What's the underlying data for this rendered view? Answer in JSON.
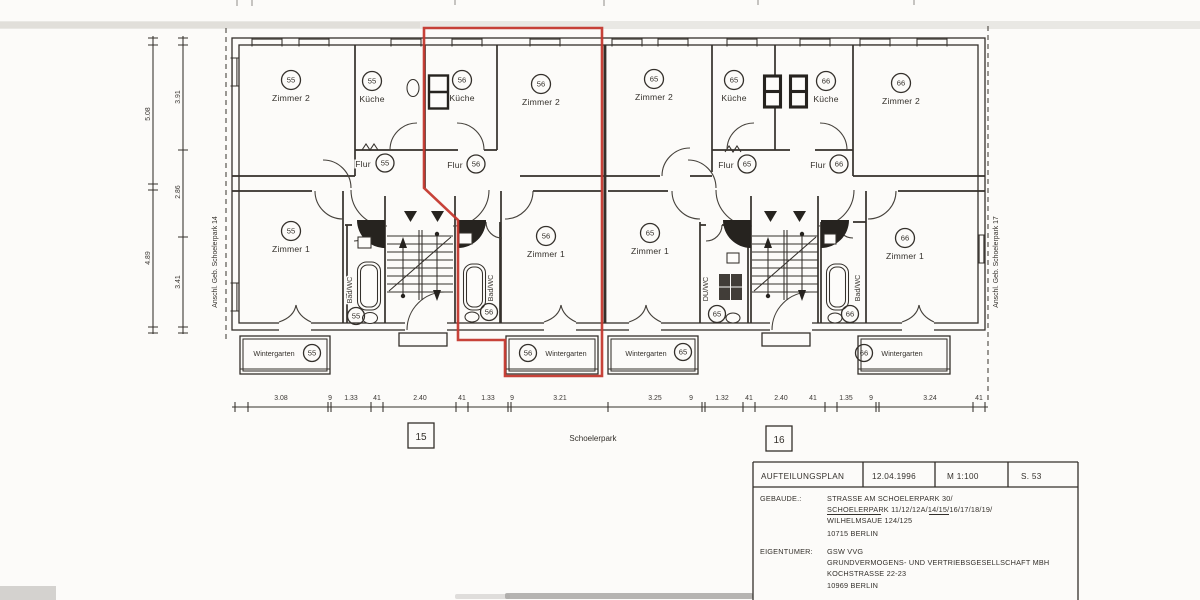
{
  "colors": {
    "paper": "#fcfbf9",
    "ink": "#34302b",
    "red_outline": "#c4382e"
  },
  "labels": {
    "zimmer1": "Zimmer 1",
    "zimmer2": "Zimmer 2",
    "kueche": "Küche",
    "flur": "Flur",
    "badwc": "Bad/WC",
    "duwc": "DU/WC",
    "wintergarten": "Wintergarten"
  },
  "units": {
    "u55": "55",
    "u56": "56",
    "u65": "65",
    "u66": "66"
  },
  "site": {
    "anschluss_left": "Anschl. Geb. Schoelerpark 14",
    "anschluss_right": "Anschl. Geb. Schoelerpark 17",
    "street": "Schoelerpark",
    "entrance_left": "15",
    "entrance_right": "16"
  },
  "dims": {
    "bottom_left": [
      "3.08",
      "9",
      "1.33",
      "41",
      "2.40",
      "41",
      "1.33",
      "9",
      "3.21"
    ],
    "bottom_right": [
      "3.25",
      "9",
      "1.32",
      "41",
      "2.40",
      "41",
      "1.35",
      "9",
      "3.24",
      "41"
    ],
    "left_outer": [
      "5.08",
      "4.89"
    ],
    "left_inner": [
      "3.91",
      "2.86",
      "3.41"
    ]
  },
  "title_block": {
    "row": {
      "title": "AUFTEILUNGSPLAN",
      "date": "12.04.1996",
      "scale": "M 1:100",
      "sheet": "S. 53"
    },
    "building_label": "GEBAUDE.:",
    "building": {
      "line1": "STRASSE AM SCHOELERPARK 30/",
      "line2_u1": "SCHOELERPARK",
      "line2_m": " 11/12/12A/14/",
      "line2_u2": "15/16",
      "line2_e": "/17/18/19/",
      "line3": "WILHELMSAUE 124/125",
      "line4": "10715 BERLIN"
    },
    "owner_label": "EIGENTUMER:",
    "owner": {
      "line1": "GSW VVG",
      "line2": "GRUNDVERMOGENS- UND VERTRIEBSGESELLSCHAFT MBH",
      "line3": "KOCHSTRASSE 22-23",
      "line4": "10969 BERLIN"
    }
  }
}
